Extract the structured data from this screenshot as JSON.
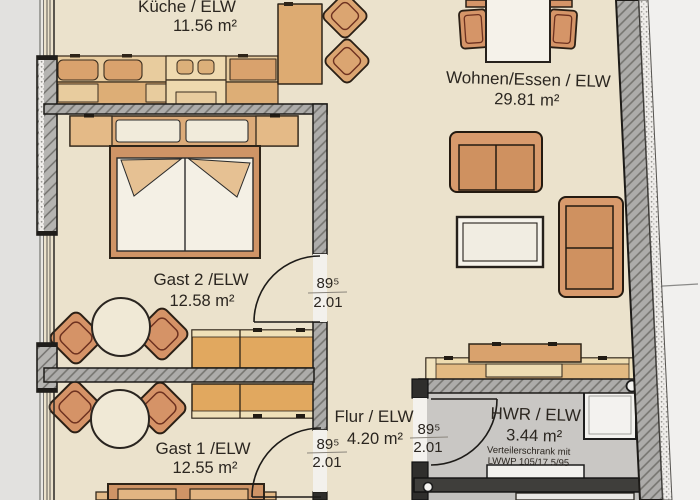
{
  "rooms": {
    "kueche": {
      "name": "Küche / ELW",
      "area": "11.56 m²"
    },
    "wohnen": {
      "name": "Wohnen/Essen / ELW",
      "area": "29.81 m²"
    },
    "gast2": {
      "name": "Gast 2 /ELW",
      "area": "12.58 m²"
    },
    "gast1": {
      "name": "Gast 1 /ELW",
      "area": "12.55 m²"
    },
    "flur": {
      "name": "Flur / ELW",
      "area": "4.20 m²"
    },
    "hwr": {
      "name": "HWR / ELW",
      "area": "3.44 m²",
      "note_line1": "Verteilerschrank mit",
      "note_line2": "LWWP 105/17.5/95"
    }
  },
  "doors": {
    "gast2": {
      "width": "89⁵",
      "height": "2.01"
    },
    "gast1": {
      "width": "89⁵",
      "height": "2.01"
    },
    "hwr": {
      "width": "89⁵",
      "height": "2.01"
    }
  },
  "colors": {
    "floor": "#ebe2cc",
    "wall": "#adacaa",
    "furniture_orange": "#d89a6c",
    "wardrobe_gold": "#e1a85f",
    "hwr_floor": "#c9c7c4",
    "paper": "#f1f0ee"
  }
}
